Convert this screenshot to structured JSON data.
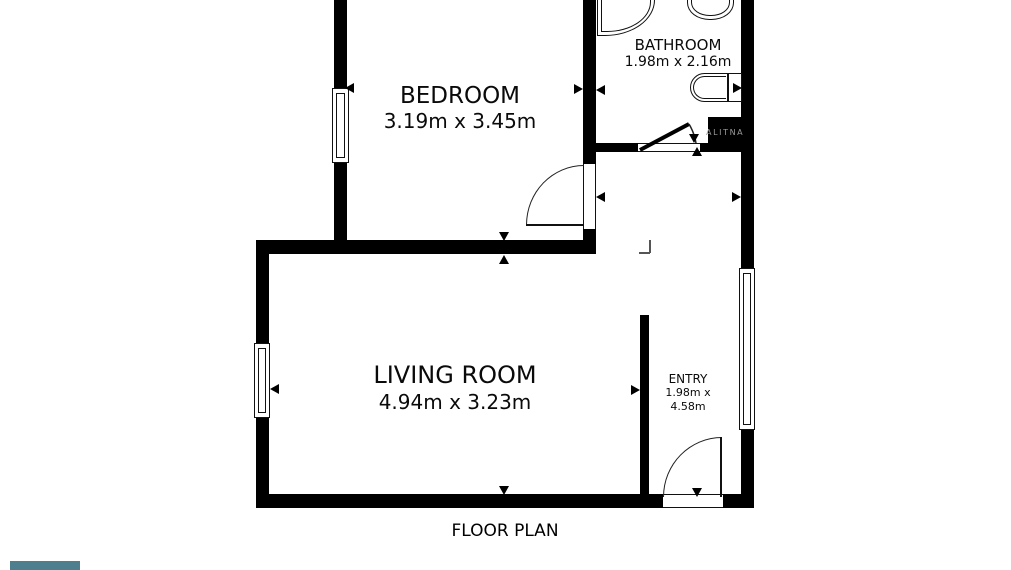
{
  "floor_plan": {
    "title": "FLOOR PLAN",
    "watermark": "ALITNA",
    "rooms": {
      "bedroom": {
        "name": "BEDROOM",
        "dims": "3.19m x 3.45m"
      },
      "bathroom": {
        "name": "BATHROOM",
        "dims": "1.98m x 2.16m"
      },
      "living_room": {
        "name": "LIVING ROOM",
        "dims": "4.94m x 3.23m"
      },
      "entry": {
        "name": "ENTRY",
        "dims_line1": "1.98m x",
        "dims_line2": "4.58m"
      }
    },
    "colors": {
      "wall": "#000000",
      "background": "#ffffff",
      "accent_swatch": "#4d7f8e",
      "watermark_text": "#9a9a9a"
    }
  }
}
